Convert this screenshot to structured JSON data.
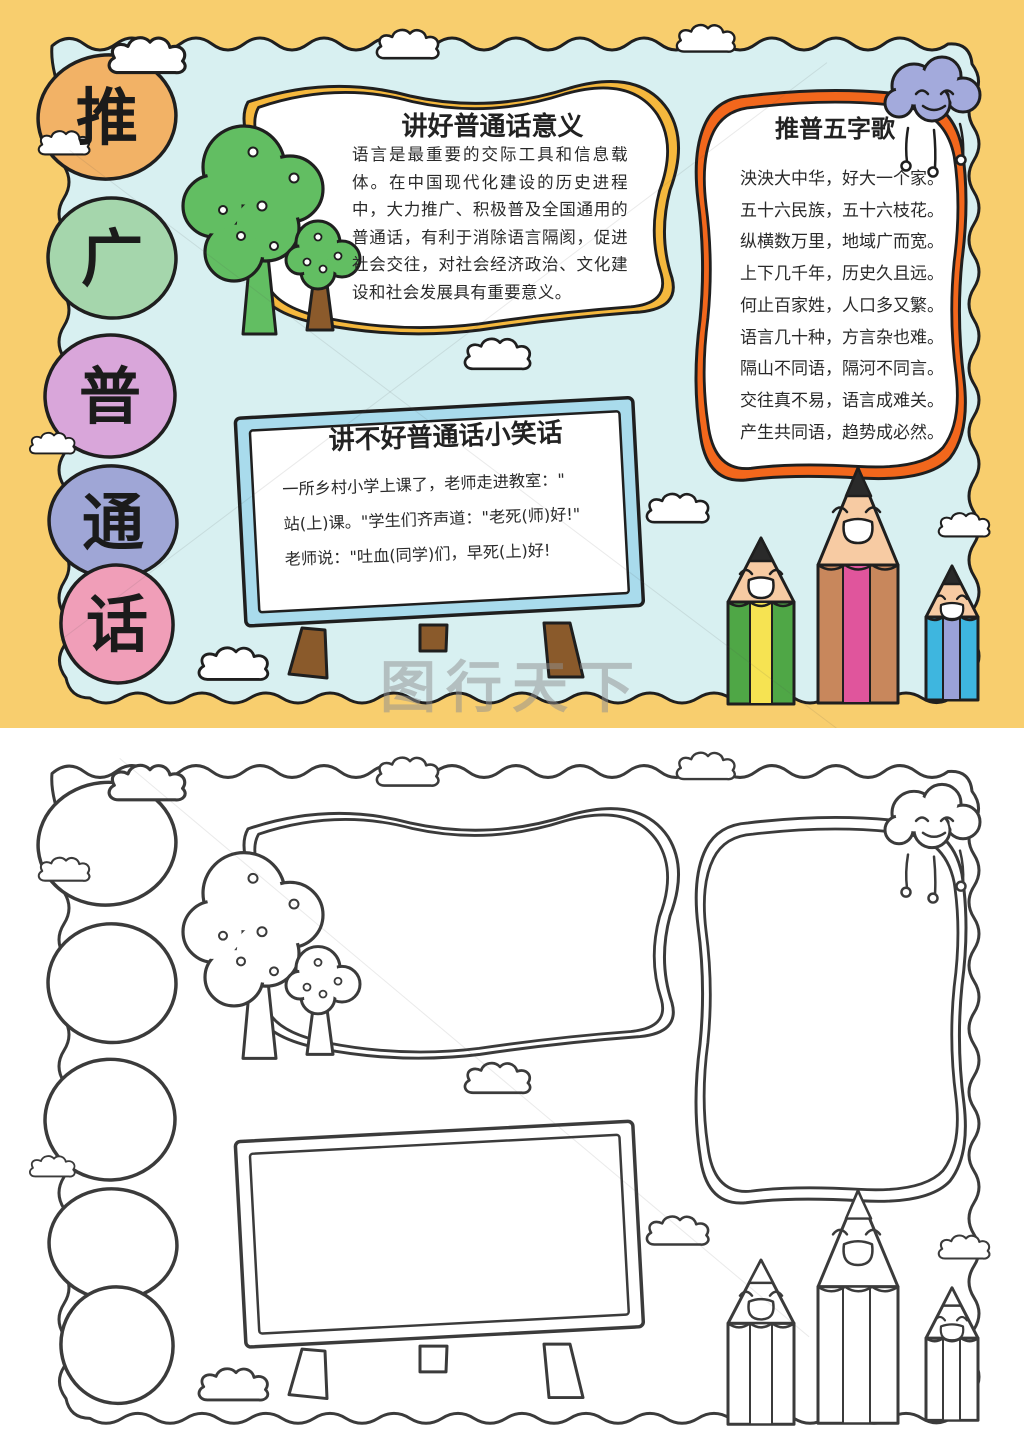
{
  "colors": {
    "border-yellow": "#F8CE6E",
    "paper-cyan": "#D8F0F1",
    "ink": "#1F1F1F",
    "line-gray": "#3B3B3B",
    "circle-tui": "#F2B266",
    "circle-guang": "#A5D6AC",
    "circle-pu": "#D9A6DA",
    "circle-tong": "#9FA6D6",
    "circle-hua": "#F09EB8",
    "frame-yellow": "#F5B83D",
    "frame-orange": "#F2671C",
    "board-blue": "#A9DBEC",
    "leg-brown": "#8A5A2B",
    "foliage-green": "#62BE62",
    "trunk-brown": "#8B5A2B",
    "cloud-purple": "#A3AADC",
    "pencil-green": "#4FA746",
    "pencil-yellow": "#F6E352",
    "pencil-brown": "#C8875C",
    "pencil-pink": "#E0559C",
    "pencil-blue": "#3EB6DF",
    "pencil-violet": "#9AA2D8",
    "pencil-face": "#F7CBA3",
    "watermark-gray": "#909090"
  },
  "vertical_title": {
    "chars": [
      "推",
      "广",
      "普",
      "通",
      "话"
    ]
  },
  "panels": {
    "meaning": {
      "title": "讲好普通话意义",
      "body": "语言是最重要的交际工具和信息载体。在中国现代化建设的历史进程中，大力推广、积极普及全国通用的普通话，有利于消除语言隔阂，促进社会交往，对社会经济政治、文化建设和社会发展具有重要意义。"
    },
    "song": {
      "title": "推普五字歌",
      "lines": [
        "泱泱大中华，好大一个家。",
        "五十六民族，五十六枝花。",
        "纵横数万里，地域广而宽。",
        "上下几千年，历史久且远。",
        "何止百家姓，人口多又繁。",
        "语言几十种，方言杂也难。",
        "隔山不同语，隔河不同言。",
        "交往真不易，语言成难关。",
        "产生共同语，趋势成必然。"
      ]
    },
    "joke": {
      "title": "讲不好普通话小笑话",
      "lines": [
        "一所乡村小学上课了，老师走进教室：\"",
        "站(上)课。\"学生们齐声道：\"老死(师)好!\"",
        "老师说：\"吐血(同学)们，早死(上)好!"
      ]
    }
  },
  "watermark": {
    "text": "图行天下"
  }
}
